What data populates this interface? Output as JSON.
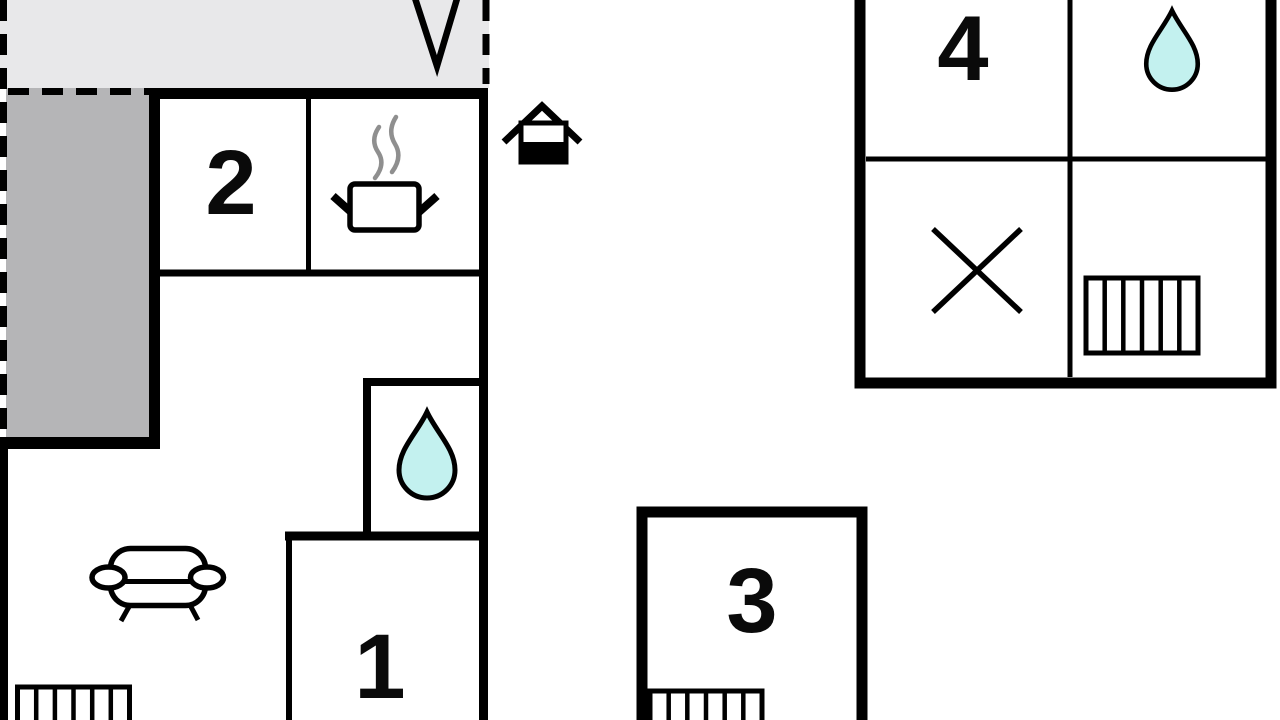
{
  "rooms": {
    "r1": "1",
    "r2": "2",
    "r3": "3",
    "r4": "4"
  },
  "icons": {
    "entrance": "main-entrance",
    "kitchen": "cooking-pot",
    "bathroom": "water-drop",
    "stairs": "stairs",
    "living": "sofa",
    "cross": "x-mark",
    "arrow": "arrow-tip"
  },
  "colors": {
    "wall": "#000000",
    "terrace_light": "#e8e8ea",
    "terrace_dark": "#b5b5b7",
    "water_drop": "#c3f1ef",
    "steam": "#8f8f8f",
    "background": "#ffffff"
  }
}
